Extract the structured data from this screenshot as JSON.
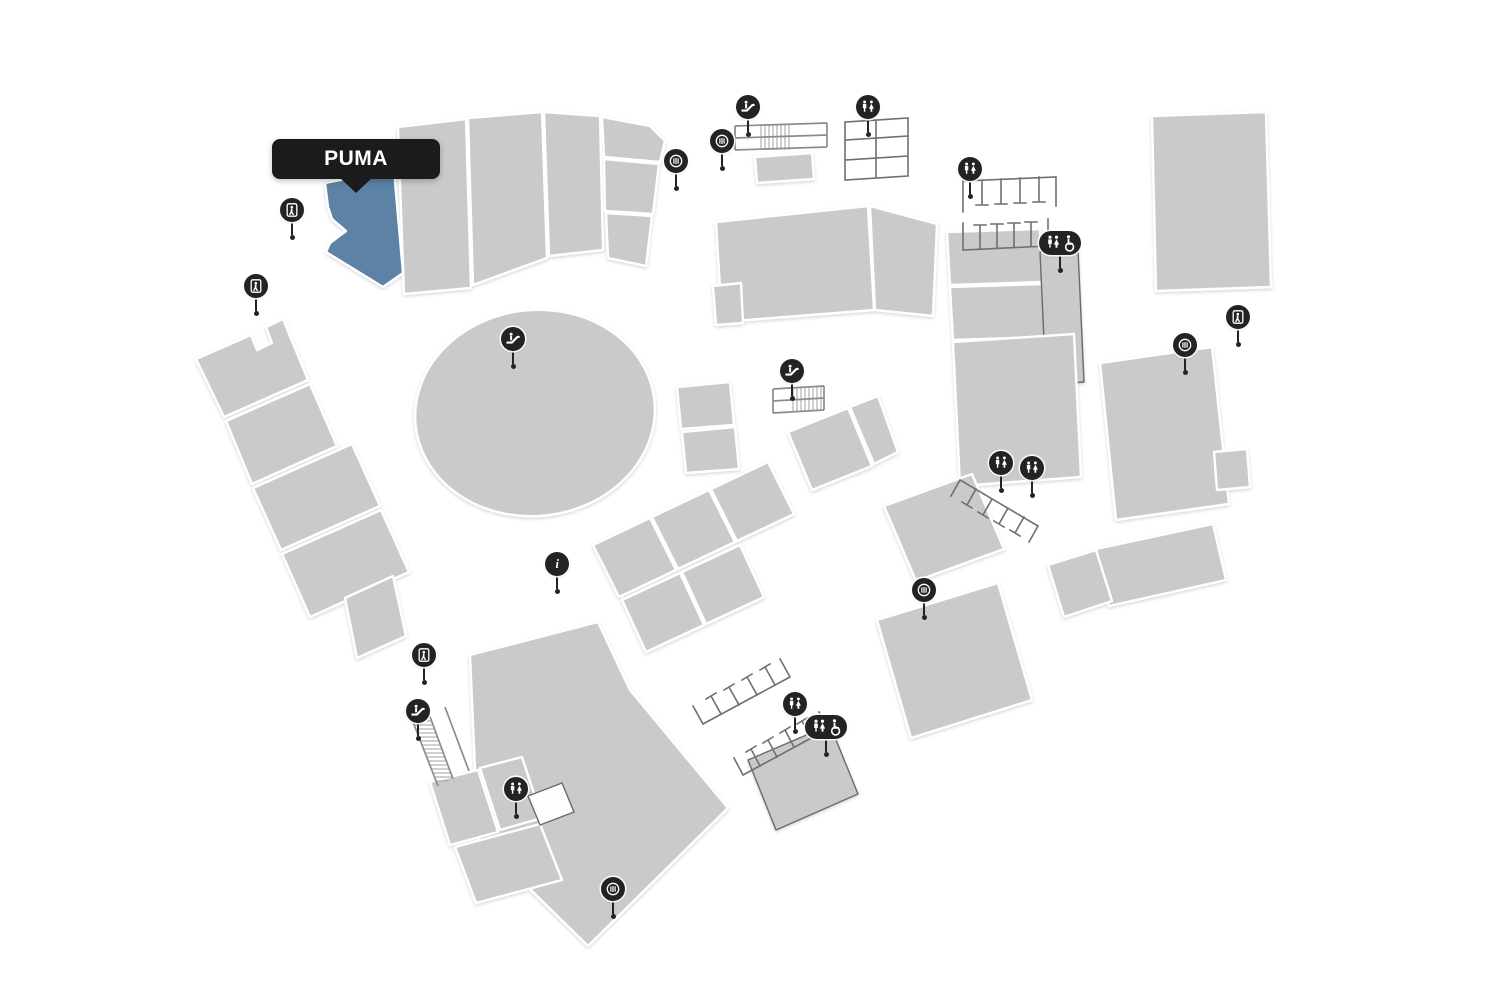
{
  "map": {
    "tooltip": {
      "label": "PUMA"
    },
    "highlighted_store": {
      "name": "PUMA"
    },
    "glyphs": {
      "info": "i"
    },
    "colors": {
      "background": "#ffffff",
      "building": "#c9cac9",
      "building_border": "#ffffff",
      "highlight": "#5c82a5",
      "pin": "#232323",
      "pin_glyph": "#ffffff",
      "structure_line": "#6f6f6f",
      "tooltip_bg": "#1b1b1d",
      "tooltip_text": "#ffffff"
    },
    "markers": [
      {
        "type": "escalator",
        "x": 748,
        "y": 107
      },
      {
        "type": "atm",
        "x": 722,
        "y": 141
      },
      {
        "type": "restroom",
        "x": 868,
        "y": 107
      },
      {
        "type": "atm",
        "x": 676,
        "y": 161
      },
      {
        "type": "restroom",
        "x": 970,
        "y": 169
      },
      {
        "type": "accessible-restroom",
        "x": 1060,
        "y": 243
      },
      {
        "type": "exit",
        "x": 292,
        "y": 210
      },
      {
        "type": "exit",
        "x": 256,
        "y": 286
      },
      {
        "type": "escalator",
        "x": 513,
        "y": 339
      },
      {
        "type": "escalator",
        "x": 792,
        "y": 371
      },
      {
        "type": "exit",
        "x": 1238,
        "y": 317
      },
      {
        "type": "atm",
        "x": 1185,
        "y": 345
      },
      {
        "type": "restroom",
        "x": 1001,
        "y": 463
      },
      {
        "type": "restroom",
        "x": 1032,
        "y": 468
      },
      {
        "type": "info",
        "x": 557,
        "y": 564
      },
      {
        "type": "atm",
        "x": 924,
        "y": 590
      },
      {
        "type": "exit",
        "x": 424,
        "y": 655
      },
      {
        "type": "escalator",
        "x": 418,
        "y": 711
      },
      {
        "type": "restroom",
        "x": 795,
        "y": 704
      },
      {
        "type": "accessible-restroom",
        "x": 826,
        "y": 727
      },
      {
        "type": "restroom",
        "x": 516,
        "y": 789
      },
      {
        "type": "atm",
        "x": 613,
        "y": 889
      }
    ]
  }
}
